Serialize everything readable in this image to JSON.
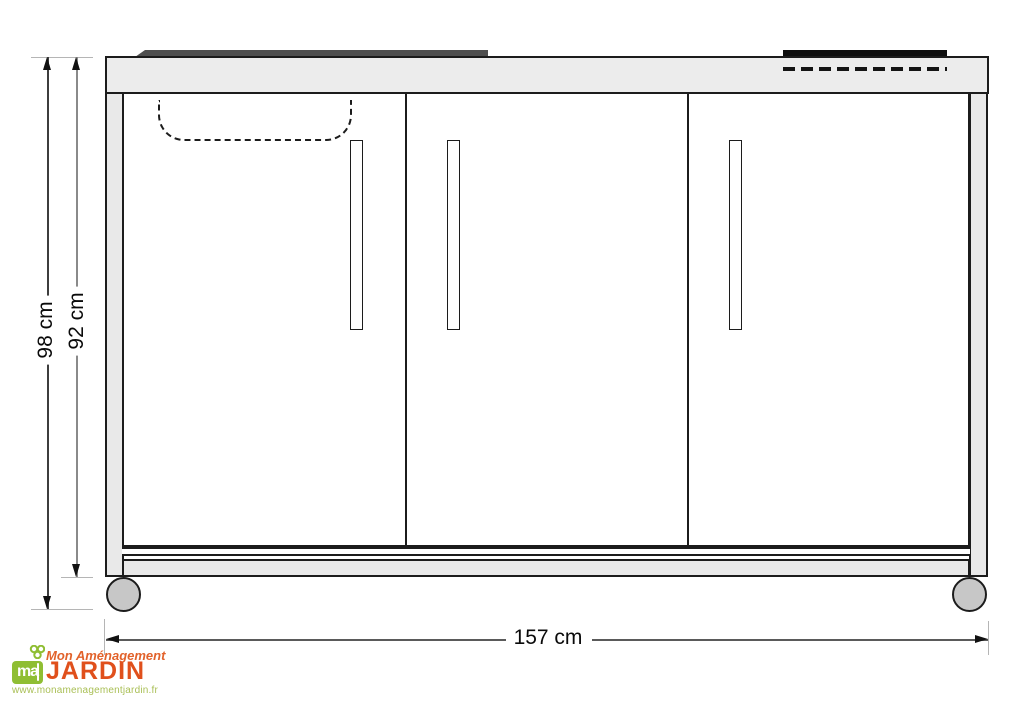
{
  "diagram": {
    "type": "furniture-dimension-drawing",
    "subject": "outdoor mini-kitchen cabinet, front elevation",
    "components": [
      {
        "name": "sink-rim",
        "style": "dark bar on counter top, left"
      },
      {
        "name": "sink-bowl-outline",
        "style": "dashed U shape under counter"
      },
      {
        "name": "cooktop",
        "style": "black bar on counter top, right, dashed line beneath"
      },
      {
        "name": "doors",
        "count": 3
      },
      {
        "name": "door-handles",
        "count": 3
      },
      {
        "name": "wheels",
        "count": 2
      }
    ],
    "colors": {
      "outline": "#1c1c1c",
      "counter_fill": "#ececec",
      "panel_fill": "#e9e9e9",
      "sink_rim": "#4f4f4f",
      "cooktop": "#0f0f0f",
      "wheel_fill": "#c7c7c7"
    }
  },
  "measurements": {
    "height_overall": {
      "label": "98 cm",
      "value": 98,
      "unit": "cm"
    },
    "height_body": {
      "label": "92 cm",
      "value": 92,
      "unit": "cm"
    },
    "width_overall": {
      "label": "157 cm",
      "value": 157,
      "unit": "cm"
    }
  },
  "logo": {
    "icon": "clover-icon",
    "brand_top": "Mon Aménagement",
    "icon_text": "ma",
    "brand_main": "JARDIN",
    "website": "www.monamenagementjardin.fr",
    "colors": {
      "orange": "#e0501c",
      "green": "#8fbe33",
      "url_green": "#a9bf55"
    }
  }
}
